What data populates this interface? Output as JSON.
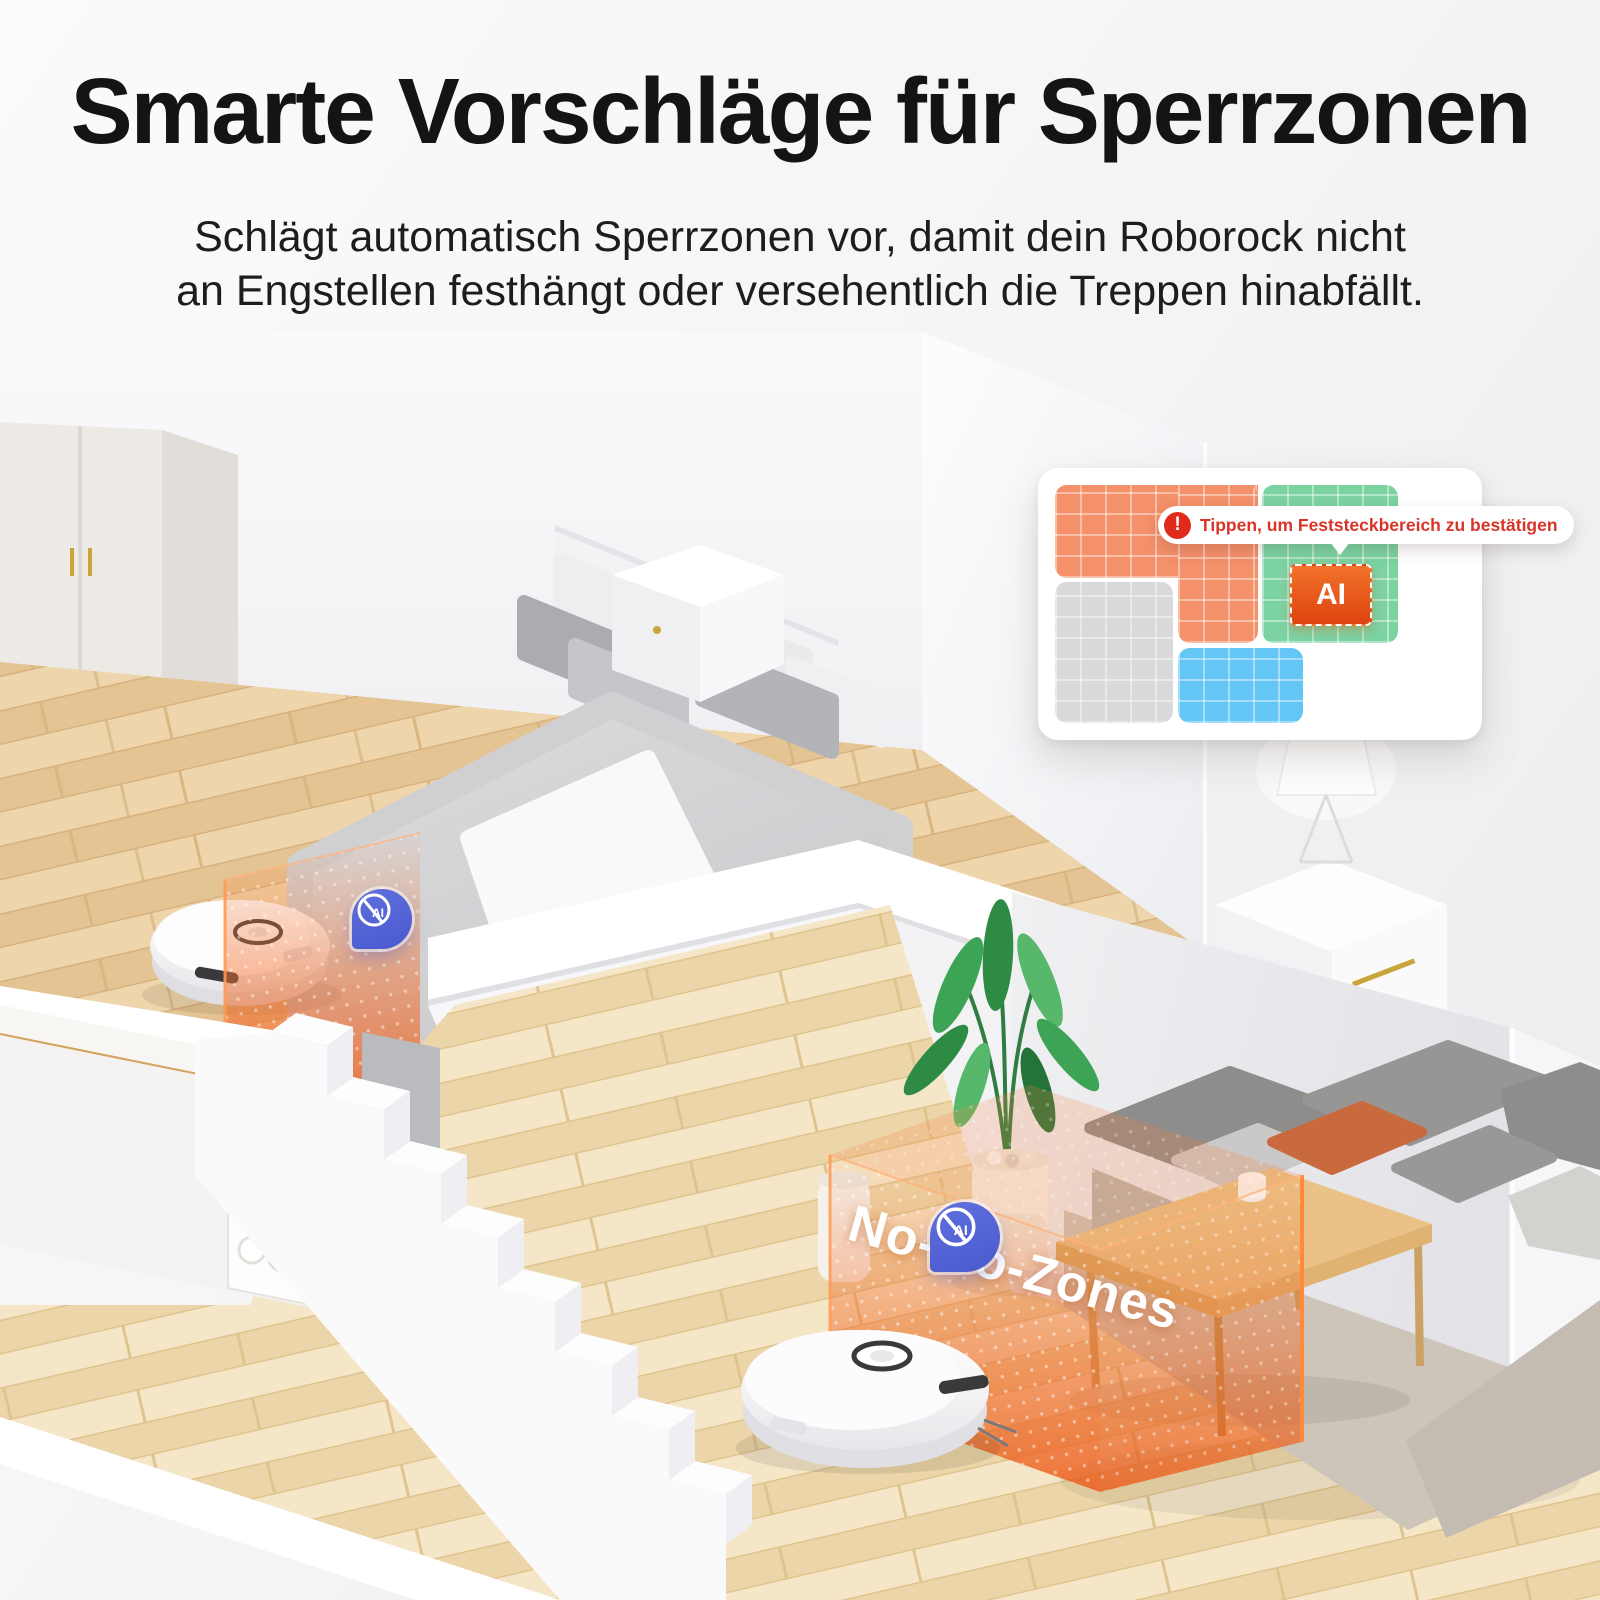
{
  "header": {
    "title": "Smarte Vorschläge für Sperrzonen",
    "subtitle_line1": "Schlägt automatisch Sperrzonen vor, damit dein Roborock nicht",
    "subtitle_line2": "an Engstellen festhängt oder versehentlich die Treppen hinabfällt."
  },
  "map_card": {
    "tooltip_text": "Tippen, um Feststeckbereich zu bestätigen",
    "alert_icon_glyph": "!",
    "ai_button_label": "AI",
    "colors": {
      "orange_zone": "#f4906a",
      "green_zone": "#7cd3a2",
      "gray_zone": "#d9d9db",
      "blue_zone": "#63c6f4",
      "ai_button": "#e8511a",
      "tooltip_text_color": "#d93429"
    }
  },
  "scene": {
    "no_go_label": "No-Go-Zones",
    "ai_pin_label": "AI",
    "colors": {
      "no_go_zone_orange": "#f07030",
      "ai_pin_blue": "#5566d6",
      "upper_floor_wood": "#e9cda1",
      "lower_floor_wood": "#f1dfba"
    }
  }
}
